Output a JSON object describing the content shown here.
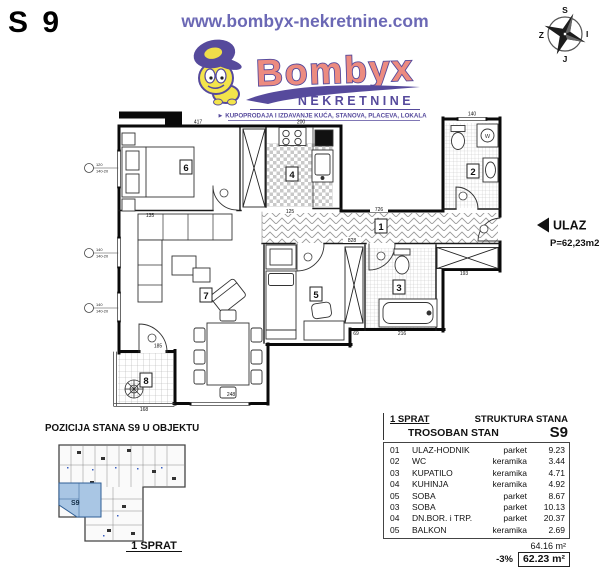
{
  "header": {
    "unit_code": "S 9",
    "website": "www.bombyx-nekretnine.com",
    "brand": "Bombyx",
    "brand_sub": "NEKRETNINE",
    "tagline": "► KUPOPRODAJA I IZDAVANJE KUĆA, STANOVA, PLACEVA, LOKALA",
    "compass": {
      "n": "S",
      "w": "Z",
      "e": "I",
      "s": "J"
    },
    "colors": {
      "purple": "#564a9c",
      "salmon": "#ec8b80",
      "url_blue": "#6b68b5",
      "unit_blue": "#a9c6e4"
    }
  },
  "plan": {
    "entrance": {
      "label": "ULAZ",
      "area": "P=62,23m2"
    },
    "washer_label": "W",
    "rooms": {
      "r1": "1",
      "r2": "2",
      "r3": "3",
      "r4": "4",
      "r5": "5",
      "r6": "6",
      "r7": "7",
      "r8": "8"
    },
    "dims": {
      "top_left": "417",
      "top_kitchen": "200",
      "top_wc": "140",
      "hall": "726",
      "hall_lower": "828",
      "room6": "135",
      "kitchen": "125",
      "dining": "248",
      "balcony_door": "185",
      "balcony": "168",
      "bath": "216",
      "closet": "193",
      "step": "69"
    },
    "window_tags": {
      "t1a": "120",
      "t1b": "140-20",
      "t2a": "140",
      "t2b": "140-20",
      "t3a": "140",
      "t3b": "140-20"
    }
  },
  "position": {
    "title": "POZICIJA STANA S9 U OBJEKTU",
    "floor": "1 SPRAT",
    "unit": "S9"
  },
  "table": {
    "floor": "1 SPRAT",
    "structure": "STRUKTURA STANA",
    "type": "TROSOBAN STAN",
    "unit": "S9",
    "rows": [
      {
        "num": "01",
        "name": "ULAZ-HODNIK",
        "material": "parket",
        "area": "9.23"
      },
      {
        "num": "02",
        "name": "WC",
        "material": "keramika",
        "area": "3.44"
      },
      {
        "num": "03",
        "name": "KUPATILO",
        "material": "keramika",
        "area": "4.71"
      },
      {
        "num": "04",
        "name": "KUHINJA",
        "material": "keramika",
        "area": "4.92"
      },
      {
        "num": "05",
        "name": "SOBA",
        "material": "parket",
        "area": "8.67"
      },
      {
        "num": "03",
        "name": "SOBA",
        "material": "parket",
        "area": "10.13"
      },
      {
        "num": "04",
        "name": "DN.BOR. i TRP.",
        "material": "parket",
        "area": "20.37"
      },
      {
        "num": "05",
        "name": "BALKON",
        "material": "keramika",
        "area": "2.69"
      }
    ],
    "total": "64.16 m²",
    "discount": "-3%",
    "net": "62.23 m²"
  }
}
